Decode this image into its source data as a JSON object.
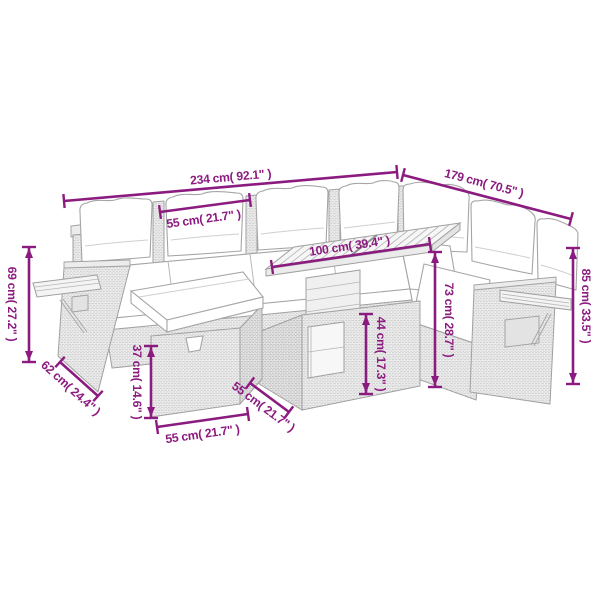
{
  "diagram": {
    "type": "product-dimension-diagram",
    "subject": "rattan corner garden sofa set with coffee table and footstool",
    "accent_color": "#8C1B80",
    "line_color": "#A0A0A0",
    "background_color": "#FFFFFF",
    "dimensions": {
      "overall_width": "234 cm( 92.1\" )",
      "right_side_length": "179 cm( 70.5\" )",
      "seat_width": "55 cm( 21.7\" )",
      "table_top_width": "100 cm( 39.4\" )",
      "left_arm_height": "69 cm( 27.2\" )",
      "seat_depth": "62 cm( 24.4\" )",
      "footstool_height": "37 cm( 14.6\" )",
      "footstool_width": "55 cm( 21.7\" )",
      "table_depth": "55 cm( 21.7\" )",
      "table_base_height": "44 cm( 17.3\" )",
      "table_height": "73 cm( 28.7\" )",
      "back_height": "85 cm( 33.5\" )"
    }
  }
}
